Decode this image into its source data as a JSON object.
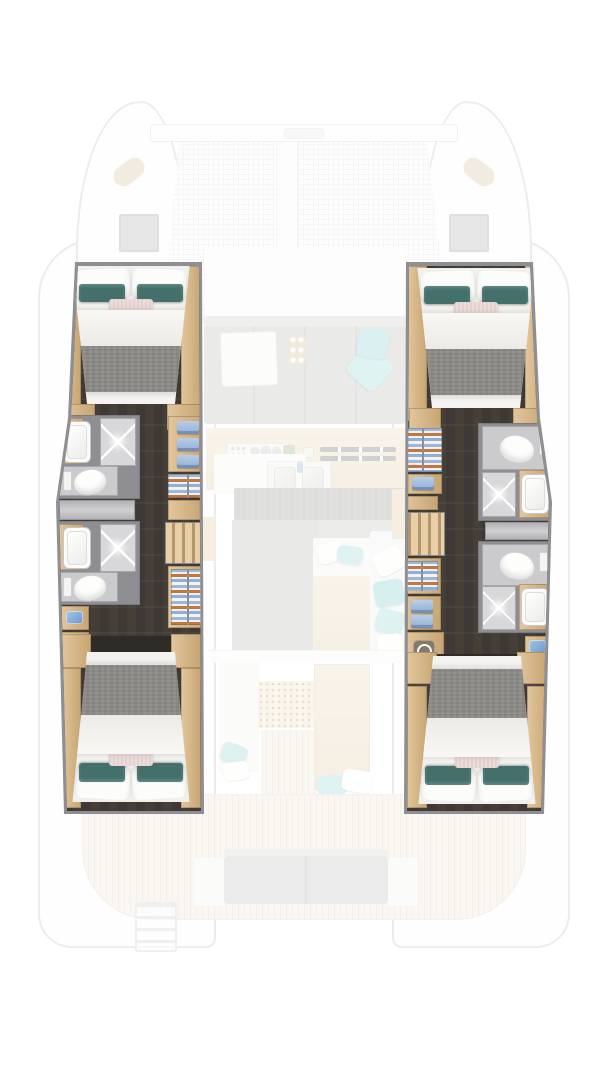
{
  "diagram": {
    "kind": "catamaran interior floor plan, top-down",
    "highlighted_areas": [
      "port forward cabin with double bed",
      "port forward bathroom (sink, shower, toilet)",
      "port aft bathroom (sink, shower, toilet)",
      "port corridor with wardrobe, shelves and stairs",
      "port aft cabin with double bed",
      "starboard forward cabin with double bed",
      "starboard forward bathroom (toilet, shower, sink)",
      "starboard aft bathroom (toilet, shower, sink)",
      "starboard corridor with wardrobe, washing machine and stairs",
      "starboard aft cabin with double bed"
    ],
    "faded_areas": [
      "bow trampoline net with crossbeam",
      "two deck hatches",
      "saloon sofa with teal throw cushions and table",
      "galley counters with stove, double sink and vents",
      "cockpit seating with teal and white pillows and tables",
      "aft teak deck with transom bench",
      "swim ladder"
    ],
    "icons": {
      "washing_machine": "washing-machine-icon",
      "shower_light": "ceiling-spot-icon",
      "cup_tray": "cupholder-tray-icon"
    }
  },
  "colors": {
    "wall": "#8f8f93",
    "outline": "#c9c9cc",
    "floor": "#3e3934",
    "wood": "#e2c69d",
    "wood_dark": "#c7a573",
    "teal": "#44706b",
    "pink": "#ecdbd8",
    "blanket": "#8d8b88",
    "shower": "#d8d8da",
    "tile": "#cbcbcd",
    "towel": "#8fafd6",
    "orange": "#c4763d",
    "faded_teal": "#a7dedd",
    "sofa": "#c3c3c1",
    "mesh": "#e6e6e9",
    "washer": "#87796a"
  }
}
